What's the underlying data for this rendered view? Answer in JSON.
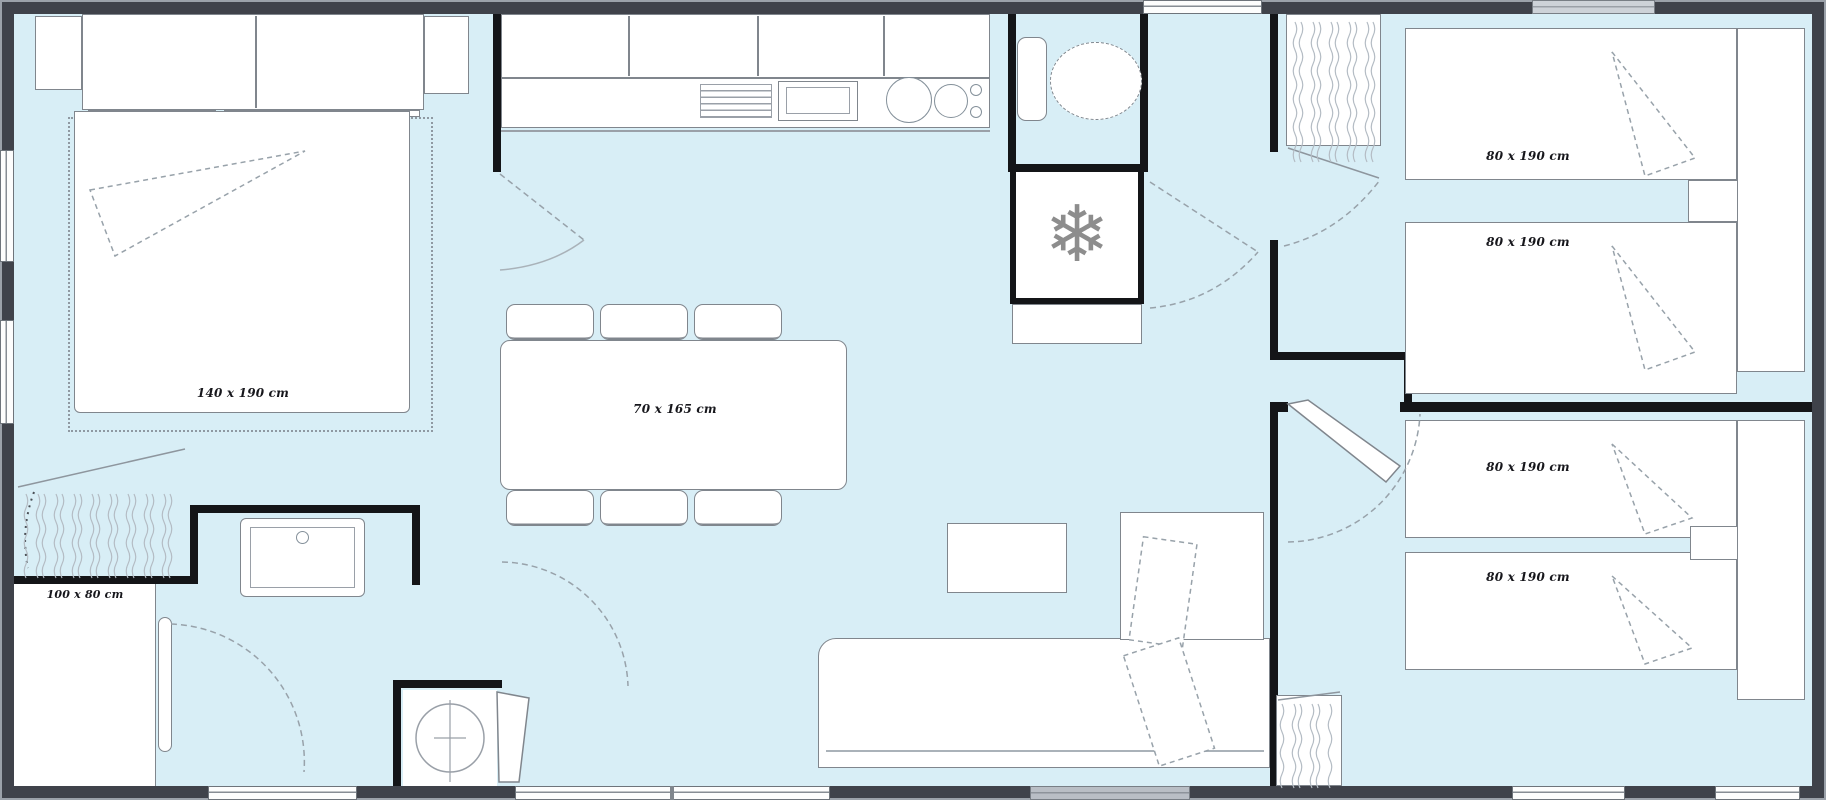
{
  "plan": {
    "type": "floorplan",
    "labels": {
      "master_bed": "140 x 190 cm",
      "dining_table": "70 x 165 cm",
      "shower": "100 x 80 cm",
      "bed_top_right_1": "80 x 190 cm",
      "bed_top_right_2": "80 x 190 cm",
      "bed_bottom_right_1": "80 x 190 cm",
      "bed_bottom_right_2": "80 x 190 cm"
    },
    "icons": {
      "fridge_glyph": "❄"
    },
    "colors": {
      "floor": "#d8eef6",
      "outer_wall": "#3f424a",
      "inner_wall": "#141518",
      "furniture_border": "#80868d"
    }
  }
}
